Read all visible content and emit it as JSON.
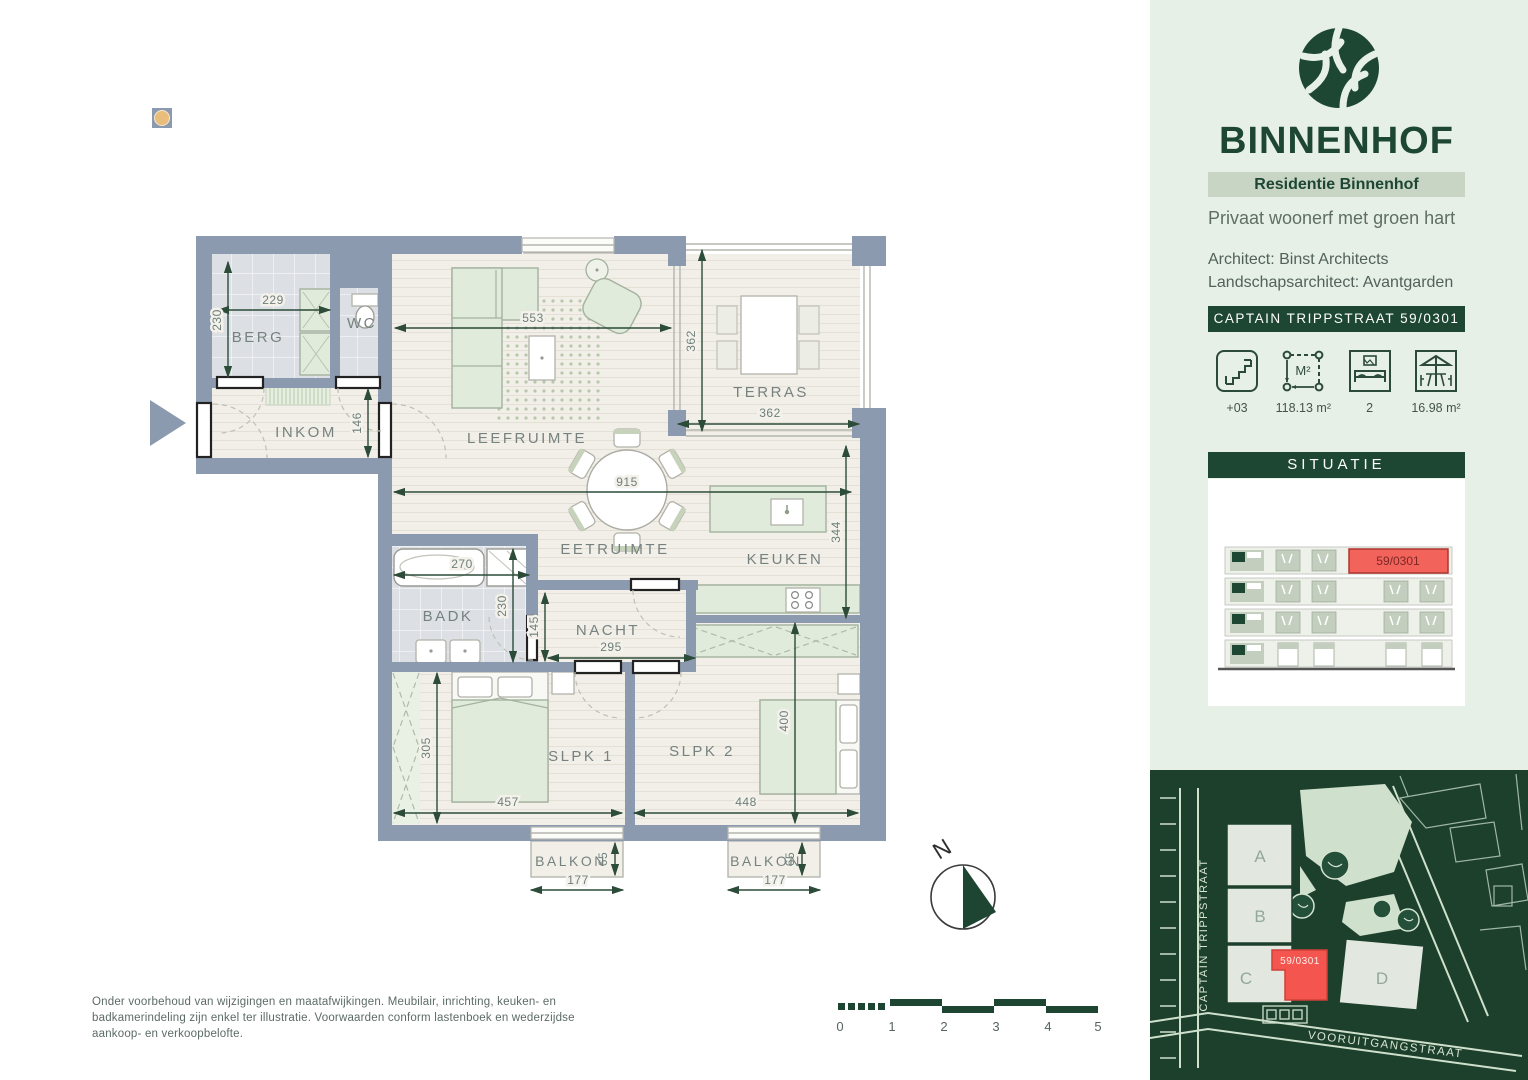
{
  "colors": {
    "dark_green": "#1d4732",
    "wall_blue_gray": "#8c9aaf",
    "accent_red": "#f4564f",
    "mint_background": "#e7f0e7",
    "map_background": "#1c402c"
  },
  "plan": {
    "rooms": {
      "berg": "BERG",
      "wc": "WC",
      "inkom": "INKOM",
      "leefruimte": "LEEFRUIMTE",
      "terras": "TERRAS",
      "eetruimte": "EETRUIMTE",
      "keuken": "KEUKEN",
      "badk": "BADK",
      "nacht": "NACHT",
      "slpk1": "SLPK 1",
      "slpk2": "SLPK 2",
      "balkon": "BALKON"
    },
    "dims": {
      "berg_w": "229",
      "berg_h": "230",
      "inkom_h": "146",
      "leef_w": "553",
      "terras_h": "362",
      "terras_w": "362",
      "eet_w": "915",
      "keuken_h": "344",
      "badk_w": "270",
      "badk_h": "230",
      "nacht_h": "145",
      "nacht_w": "295",
      "slpk1_h": "305",
      "slpk1_w": "457",
      "slpk2_w": "448",
      "slpk2_h": "400",
      "balkon_d": "65",
      "balkon_w": "177"
    },
    "north_label": "N",
    "scalebar": [
      "0",
      "1",
      "2",
      "3",
      "4",
      "5"
    ],
    "disclaimer": "Onder voorbehoud van wijzigingen en maatafwijkingen. Meubilair, inrichting, keuken- en badkamerindeling zijn enkel ter illustratie. Voorwaarden conform lastenboek en wederzijdse aankoop- en verkoopbelofte."
  },
  "sidebar": {
    "brand": "BINNENHOF",
    "residence": "Residentie Binnenhof",
    "tagline": "Privaat woonerf met groen hart",
    "architect": "Architect: Binst Architects",
    "landscape_architect": "Landschapsarchitect: Avantgarden",
    "address_banner": "CAPTAIN TRIPPSTRAAT 59/0301",
    "specs": [
      {
        "icon": "stairs-icon",
        "value": "+03"
      },
      {
        "icon": "area-icon",
        "value": "118.13 m²",
        "glyph": "M²"
      },
      {
        "icon": "bedrooms-icon",
        "value": "2"
      },
      {
        "icon": "terrace-icon",
        "value": "16.98 m²"
      }
    ],
    "situatie": {
      "title": "SITUATIE",
      "unit": "59/0301"
    },
    "map": {
      "street_left": "CAPTAIN TRIPPSTRAAT",
      "street_bottom": "VOORUITGANGSTRAAT",
      "buildings": [
        "A",
        "B",
        "C",
        "D"
      ],
      "unit": "59/0301"
    }
  }
}
